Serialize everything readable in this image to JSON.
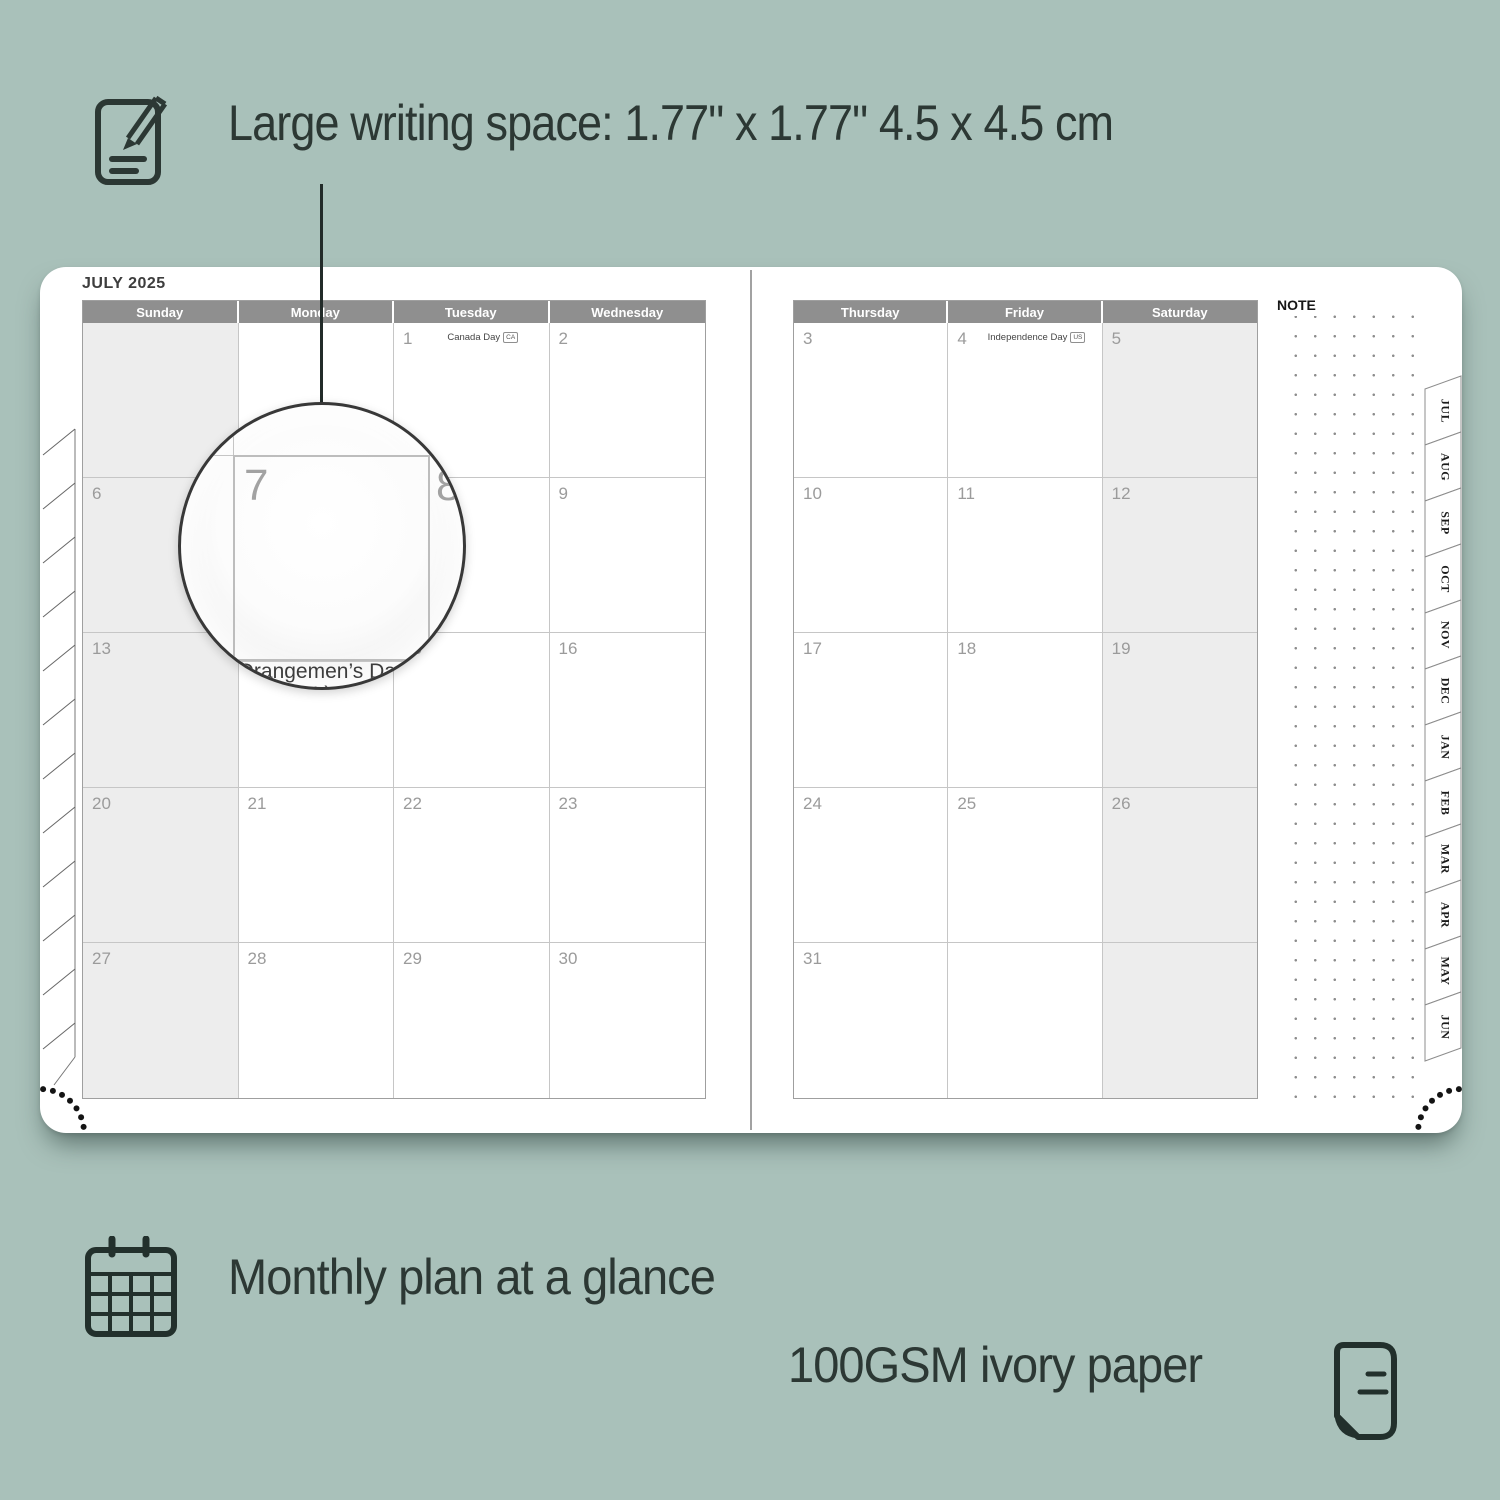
{
  "colors": {
    "background": "#a9c1ba",
    "ink": "#2c3834",
    "header_gray": "#8f8f8f",
    "shaded_column": "#ededed",
    "day_number": "#9b9b9b"
  },
  "headline": "Large writing space: 1.77\" x 1.77\" 4.5 x 4.5 cm",
  "planner": {
    "month_title": "JULY 2025",
    "note_label": "NOTE",
    "left_headers": [
      "Sunday",
      "Monday",
      "Tuesday",
      "Wednesday"
    ],
    "right_headers": [
      "Thursday",
      "Friday",
      "Saturday"
    ],
    "left_weeks": [
      [
        {
          "day": ""
        },
        {
          "day": ""
        },
        {
          "day": "1",
          "holiday": "Canada Day",
          "badge": "CA"
        },
        {
          "day": "2"
        }
      ],
      [
        {
          "day": "6"
        },
        {
          "day": "7"
        },
        {
          "day": "8"
        },
        {
          "day": "9"
        }
      ],
      [
        {
          "day": "13"
        },
        {
          "day": "14",
          "holiday": "Orangemen’s Day (N.I.)"
        },
        {
          "day": "15"
        },
        {
          "day": "16"
        }
      ],
      [
        {
          "day": "20"
        },
        {
          "day": "21"
        },
        {
          "day": "22"
        },
        {
          "day": "23"
        }
      ],
      [
        {
          "day": "27"
        },
        {
          "day": "28"
        },
        {
          "day": "29"
        },
        {
          "day": "30"
        }
      ]
    ],
    "right_weeks": [
      [
        {
          "day": "3"
        },
        {
          "day": "4",
          "holiday": "Independence Day",
          "badge": "US"
        },
        {
          "day": "5"
        }
      ],
      [
        {
          "day": "10"
        },
        {
          "day": "11"
        },
        {
          "day": "12"
        }
      ],
      [
        {
          "day": "17"
        },
        {
          "day": "18"
        },
        {
          "day": "19"
        }
      ],
      [
        {
          "day": "24"
        },
        {
          "day": "25"
        },
        {
          "day": "26"
        }
      ],
      [
        {
          "day": "31"
        },
        {
          "day": ""
        },
        {
          "day": ""
        }
      ]
    ],
    "month_tabs": [
      "JUL",
      "AUG",
      "SEP",
      "OCT",
      "NOV",
      "DEC",
      "JAN",
      "FEB",
      "MAR",
      "APR",
      "MAY",
      "JUN"
    ]
  },
  "magnifier": {
    "day": "7",
    "next_day": "8",
    "holiday_line1": "Orangemen’s Day",
    "holiday_line2": "(N.I.)"
  },
  "features": {
    "monthly": "Monthly plan at a glance",
    "paper": "100GSM ivory paper"
  }
}
